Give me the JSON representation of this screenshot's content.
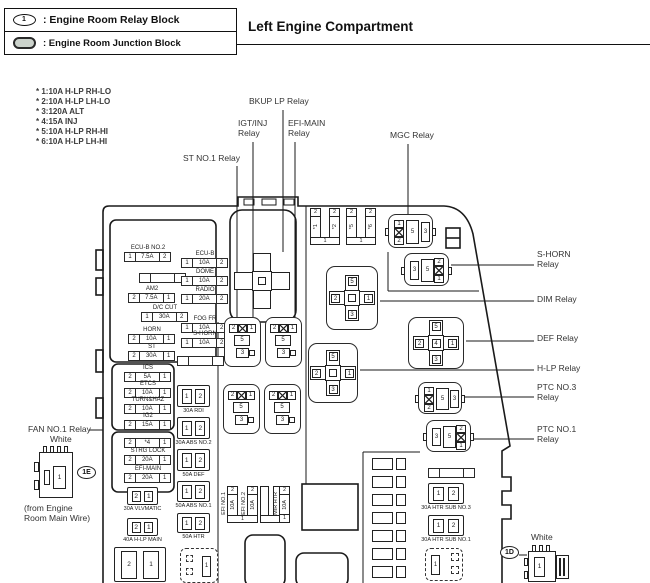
{
  "legend": {
    "rows": [
      {
        "icon": "relay-block-oval-icon",
        "symbol": "1",
        "label": ": Engine Room Relay Block"
      },
      {
        "icon": "junction-block-oval-icon",
        "symbol": "",
        "label": ": Engine Room Junction Block"
      }
    ]
  },
  "title": "Left Engine Compartment",
  "fuse_notes": [
    "* 1:10A H-LP RH-LO",
    "* 2:10A H-LP LH-LO",
    "* 3:120A ALT",
    "* 4:15A INJ",
    "* 5:10A H-LP RH-HI",
    "* 6:10A H-LP LH-HI"
  ],
  "colors": {
    "line": "#1a1a1a",
    "background": "#ffffff"
  },
  "callouts": [
    {
      "id": "bkup-lp",
      "lines": [
        "BKUP LP Relay"
      ],
      "x": 249,
      "y": 97
    },
    {
      "id": "igt-inj",
      "lines": [
        "IGT/INJ",
        "Relay"
      ],
      "x": 238,
      "y": 119
    },
    {
      "id": "efi-main",
      "lines": [
        "EFI-MAIN",
        "Relay"
      ],
      "x": 288,
      "y": 119
    },
    {
      "id": "mgc",
      "lines": [
        "MGC Relay"
      ],
      "x": 390,
      "y": 131
    },
    {
      "id": "st-no1",
      "lines": [
        "ST NO.1 Relay"
      ],
      "x": 183,
      "y": 154
    },
    {
      "id": "s-horn",
      "lines": [
        "S-HORN",
        "Relay"
      ],
      "x": 537,
      "y": 250
    },
    {
      "id": "dim",
      "lines": [
        "DIM Relay"
      ],
      "x": 537,
      "y": 295
    },
    {
      "id": "def",
      "lines": [
        "DEF Relay"
      ],
      "x": 537,
      "y": 334
    },
    {
      "id": "h-lp",
      "lines": [
        "H-LP Relay"
      ],
      "x": 537,
      "y": 364
    },
    {
      "id": "ptc-no3",
      "lines": [
        "PTC NO.3",
        "Relay"
      ],
      "x": 537,
      "y": 383
    },
    {
      "id": "ptc-no1",
      "lines": [
        "PTC NO.1",
        "Relay"
      ],
      "x": 537,
      "y": 425
    },
    {
      "id": "fan-no1",
      "lines": [
        "FAN NO.1 Relay"
      ],
      "x": 28,
      "y": 425
    },
    {
      "id": "fan-color",
      "lines": [
        "White"
      ],
      "x": 50,
      "y": 435
    },
    {
      "id": "from-wire",
      "lines": [
        "(from Engine",
        "Room Main Wire)"
      ],
      "x": 24,
      "y": 504
    },
    {
      "id": "bottom-right-color",
      "lines": [
        "White"
      ],
      "x": 531,
      "y": 533
    }
  ],
  "fuse_boxes_3cell": [
    {
      "label": "ECU-B NO.2",
      "cells": [
        "1",
        "7.5A",
        "2"
      ],
      "x": 124,
      "y": 252
    },
    {
      "label": "ECU-B",
      "cells": [
        "1",
        "10A",
        "2"
      ],
      "x": 181,
      "y": 258
    },
    {
      "label": "",
      "cells": [
        "",
        "",
        ""
      ],
      "x": 139,
      "y": 273
    },
    {
      "label": "DOME",
      "cells": [
        "1",
        "10A",
        "2"
      ],
      "x": 181,
      "y": 276
    },
    {
      "label": "AM2",
      "cells": [
        "2",
        "7.5A",
        "1"
      ],
      "x": 128,
      "y": 293
    },
    {
      "label": "RADIO",
      "cells": [
        "1",
        "20A",
        "2"
      ],
      "x": 181,
      "y": 294
    },
    {
      "label": "D/C CUT",
      "cells": [
        "1",
        "30A",
        "2"
      ],
      "x": 141,
      "y": 312
    },
    {
      "label": "FOG FR",
      "cells": [
        "1",
        "10A",
        "2"
      ],
      "x": 181,
      "y": 323
    },
    {
      "label": "HORN",
      "cells": [
        "2",
        "10A",
        "1"
      ],
      "x": 128,
      "y": 334
    },
    {
      "label": "S-HORN",
      "cells": [
        "1",
        "10A",
        "2"
      ],
      "x": 181,
      "y": 338
    },
    {
      "label": "ST",
      "cells": [
        "2",
        "30A",
        "1"
      ],
      "x": 128,
      "y": 351
    },
    {
      "label": "",
      "cells": [
        "",
        "",
        ""
      ],
      "x": 177,
      "y": 356
    },
    {
      "label": "ICS",
      "cells": [
        "2",
        "5A",
        "1"
      ],
      "x": 124,
      "y": 372
    },
    {
      "label": "ETCS",
      "cells": [
        "2",
        "10A",
        "1"
      ],
      "x": 124,
      "y": 388
    },
    {
      "label": "TURN&HAZ",
      "cells": [
        "2",
        "10A",
        "1"
      ],
      "x": 124,
      "y": 404
    },
    {
      "label": "IG2",
      "cells": [
        "2",
        "15A",
        "1"
      ],
      "x": 124,
      "y": 420
    },
    {
      "label": "",
      "cells": [
        "2",
        "*4",
        "1"
      ],
      "x": 124,
      "y": 438
    },
    {
      "label": "STRG LOCK",
      "cells": [
        "2",
        "20A",
        "1"
      ],
      "x": 124,
      "y": 455
    },
    {
      "label": "EFI-MAIN",
      "cells": [
        "2",
        "20A",
        "1"
      ],
      "x": 124,
      "y": 473
    },
    {
      "label": "",
      "cells": [
        "",
        "",
        ""
      ],
      "x": 428,
      "y": 468
    }
  ],
  "fuse_boxes_2cell": [
    {
      "label": "30A RDI",
      "cells": [
        "1",
        "2"
      ],
      "x": 177,
      "y": 385,
      "w": 33,
      "h": 22
    },
    {
      "label": "30A ABS NO.2",
      "cells": [
        "1",
        "2"
      ],
      "x": 177,
      "y": 417,
      "w": 33,
      "h": 22
    },
    {
      "label": "50A DEF",
      "cells": [
        "1",
        "2"
      ],
      "x": 177,
      "y": 449,
      "w": 33,
      "h": 22
    },
    {
      "label": "50A ABS NO.1",
      "cells": [
        "1",
        "2"
      ],
      "x": 177,
      "y": 481,
      "w": 33,
      "h": 21
    },
    {
      "label": "50A HTR",
      "cells": [
        "1",
        "2"
      ],
      "x": 177,
      "y": 513,
      "w": 33,
      "h": 20
    },
    {
      "label": "30A VLVMATIC",
      "cells": [
        "2",
        "1"
      ],
      "x": 127,
      "y": 487,
      "w": 31,
      "h": 18
    },
    {
      "label": "40A H-LP MAIN",
      "cells": [
        "2",
        "1"
      ],
      "x": 127,
      "y": 518,
      "w": 31,
      "h": 18
    },
    {
      "label": "",
      "cells": [
        "2",
        "1"
      ],
      "x": 114,
      "y": 547,
      "w": 52,
      "h": 35
    },
    {
      "label": "30A HTR SUB NO.3",
      "cells": [
        "1",
        "2"
      ],
      "x": 428,
      "y": 483,
      "w": 36,
      "h": 21
    },
    {
      "label": "30A HTR SUB NO.1",
      "cells": [
        "1",
        "2"
      ],
      "x": 428,
      "y": 515,
      "w": 36,
      "h": 21
    }
  ],
  "fuse_slot_groups": [
    {
      "x": 310,
      "y": 208,
      "bar_w": 11,
      "gap": 8,
      "bottom": "1",
      "bars": [
        {
          "label": "",
          "top": "2",
          "body": "*1"
        },
        {
          "label": "",
          "top": "2",
          "body": "*2"
        }
      ]
    },
    {
      "x": 346,
      "y": 208,
      "bar_w": 11,
      "gap": 8,
      "bottom": "1",
      "bars": [
        {
          "label": "",
          "top": "2",
          "body": "*5"
        },
        {
          "label": "",
          "top": "2",
          "body": "*6"
        }
      ]
    },
    {
      "x": 220,
      "y": 486,
      "bar_w": 11,
      "gap": 2,
      "bottom": "1",
      "bars": [
        {
          "label": "EFI NO.1",
          "top": "2",
          "body": "10A"
        },
        {
          "label": "EFI NO.2",
          "top": "2",
          "body": "10A"
        }
      ]
    },
    {
      "x": 260,
      "y": 486,
      "bar_w": 9,
      "gap": 4,
      "bottom": "",
      "bars": [
        {
          "label": "",
          "top": "",
          "body": ""
        },
        {
          "label": "",
          "top": "",
          "body": ""
        }
      ]
    },
    {
      "x": 272,
      "y": 486,
      "bar_w": 11,
      "gap": 0,
      "bottom": "",
      "single_foot": "1",
      "bars": [
        {
          "label": "MIR HTR",
          "top": "2",
          "body": "10A"
        }
      ]
    }
  ],
  "cross_relays": [
    {
      "id": "bkup-lp",
      "cx": 262,
      "cy": 281,
      "large": true,
      "pins": {
        "top": "",
        "left": "",
        "right": "",
        "bottom": "",
        "center": ""
      }
    },
    {
      "id": "dim",
      "cx": 352,
      "cy": 298,
      "box": [
        326,
        266,
        52,
        64
      ],
      "pins": {
        "top": "5",
        "left": "2",
        "right": "1",
        "bottom": "3",
        "center": ""
      }
    },
    {
      "id": "def",
      "cx": 436,
      "cy": 343,
      "box": [
        408,
        317,
        56,
        52
      ],
      "pins": {
        "top": "5",
        "left": "2",
        "right": "1",
        "bottom": "3",
        "center": "4"
      }
    },
    {
      "id": "h-lp",
      "cx": 333,
      "cy": 373,
      "box": [
        308,
        343,
        50,
        60
      ],
      "pins": {
        "top": "5",
        "left": "2",
        "right": "1",
        "bottom": "3",
        "center": ""
      }
    }
  ],
  "micro_relays": [
    {
      "id": "mgc",
      "x": 388,
      "y": 214,
      "w": 45,
      "h": 34,
      "mirror": false,
      "stack": [
        "1",
        "2"
      ],
      "mid": "5",
      "side": "3"
    },
    {
      "id": "s-horn",
      "x": 404,
      "y": 253,
      "w": 45,
      "h": 33,
      "mirror": true,
      "stack": [
        "2",
        "1"
      ],
      "mid": "5",
      "side": "3"
    },
    {
      "id": "ptc-no3",
      "x": 418,
      "y": 382,
      "w": 44,
      "h": 32,
      "mirror": false,
      "stack": [
        "1",
        "2"
      ],
      "mid": "5",
      "side": "3"
    },
    {
      "id": "ptc-no1",
      "x": 426,
      "y": 420,
      "w": 45,
      "h": 32,
      "mirror": true,
      "stack": [
        "2",
        "1"
      ],
      "mid": "5",
      "side": "3"
    }
  ],
  "mini_relays": [
    {
      "x": 224,
      "y": 317,
      "top": [
        "2",
        "1"
      ],
      "mid": "5",
      "bottom": "3"
    },
    {
      "x": 265,
      "y": 317,
      "top": [
        "2",
        "1"
      ],
      "mid": "5",
      "bottom": "3"
    },
    {
      "x": 223,
      "y": 384,
      "top": [
        "2",
        "1"
      ],
      "mid": "5",
      "bottom": "3"
    },
    {
      "x": 264,
      "y": 384,
      "top": [
        "2",
        "1"
      ],
      "mid": "5",
      "bottom": "3"
    }
  ],
  "connectors": {
    "fan": {
      "pin": "1"
    },
    "dashed_left": {
      "pin": "1"
    },
    "dashed_right": {
      "pin": "1"
    },
    "bottom_right": {
      "pin": "1"
    }
  },
  "grommets": [
    {
      "text": "1E",
      "x": 77,
      "y": 466
    },
    {
      "text": "1D",
      "x": 500,
      "y": 546
    }
  ]
}
